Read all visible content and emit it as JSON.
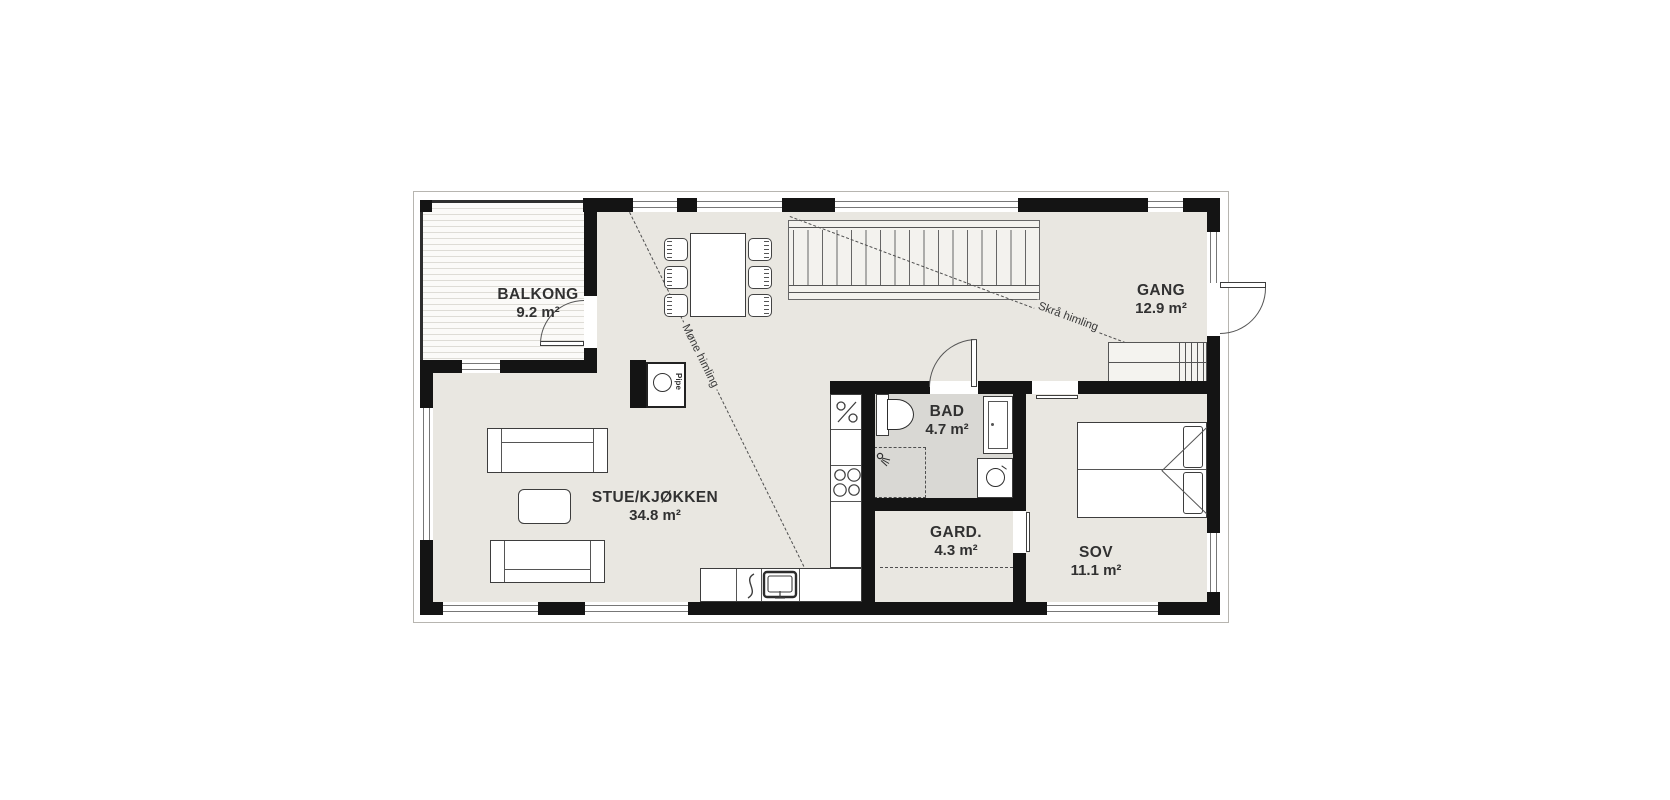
{
  "rooms": [
    {
      "id": "balkong",
      "name": "BALKONG",
      "area": "9.2 m²"
    },
    {
      "id": "stue-kjokken",
      "name": "STUE/KJØKKEN",
      "area": "34.8 m²"
    },
    {
      "id": "gang",
      "name": "GANG",
      "area": "12.9 m²"
    },
    {
      "id": "bad",
      "name": "BAD",
      "area": "4.7 m²"
    },
    {
      "id": "gard",
      "name": "GARD.",
      "area": "4.3 m²"
    },
    {
      "id": "sov",
      "name": "SOV",
      "area": "11.1 m²"
    }
  ],
  "annotations": {
    "sloped_ceiling": "Skrå himling",
    "ridge_ceiling": "Møne himling",
    "chimney": "Pipe"
  },
  "colors": {
    "wall": "#141414",
    "floor": "#e9e7e1",
    "bath_floor": "#d9d8d4",
    "line": "#4a4a4a",
    "background": "#ffffff"
  }
}
